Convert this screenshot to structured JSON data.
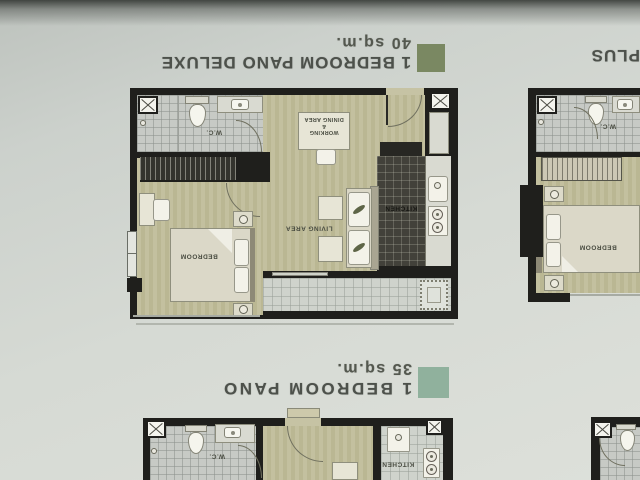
{
  "titles": {
    "deluxe": {
      "name": "1 BEDROOM PANO DELUXE",
      "area": "40 sq.m.",
      "swatch_color": "#7a8862"
    },
    "plus": {
      "name": "PLUS"
    },
    "pano": {
      "name": "1 BEDROOM PANO",
      "area": "35 sq.m.",
      "swatch_color": "#90b19d"
    }
  },
  "rooms": {
    "deluxe": {
      "wc": "W.C.",
      "working_dining": [
        "WORKING",
        "&",
        "DINING AREA"
      ],
      "kitchen": "KITCHEN",
      "living": "LIVING AREA",
      "bedroom": "BEDROOM"
    },
    "plus": {
      "wc": "W.C.",
      "bedroom": "BEDROOM"
    },
    "pano": {
      "wc": "W.C.",
      "kitchen": "KITCHEN"
    }
  },
  "colors": {
    "paper": "#d6dad4",
    "wall": "#1f1f1c",
    "unit_floor": "#c0bd9c",
    "wc_tile": "#c7cac5",
    "balcony_tile": "#cfd3cc",
    "kitchen_floor": "#42413a"
  }
}
